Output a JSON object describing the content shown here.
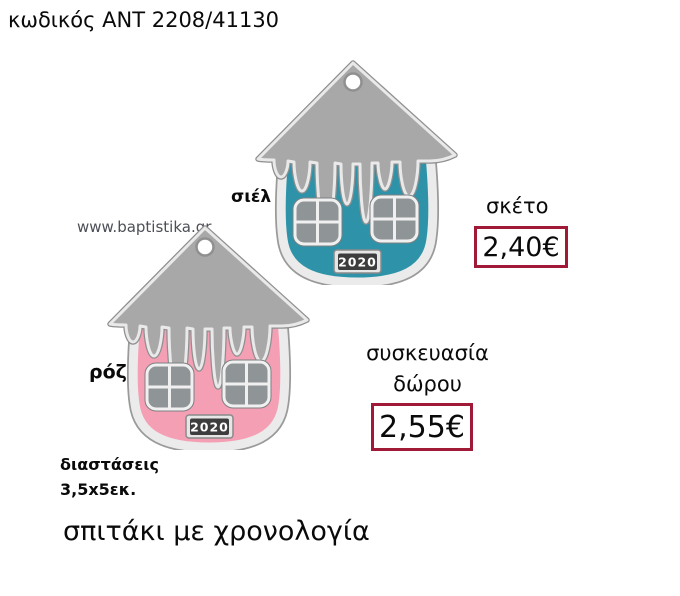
{
  "header": {
    "product_code": "κωδικός ΑΝΤ 2208/41130"
  },
  "watermark": {
    "text": "www.baptistika.gr",
    "color": "#4c4f56"
  },
  "product": {
    "year": "2020",
    "caption": "σπιτάκι με χρονολογία",
    "dimensions_label": "διαστάσεις",
    "dimensions_value": "3,5x5εκ."
  },
  "variants": [
    {
      "label": "σιέλ",
      "color": "#2e93a8"
    },
    {
      "label": "ρόζ",
      "color": "#f59fb5"
    }
  ],
  "pricing": {
    "plain": {
      "label": "σκέτο",
      "price": "2,40€"
    },
    "gift_wrap": {
      "label_line1": "συσκευασία",
      "label_line2": "δώρου",
      "price": "2,55€"
    }
  },
  "colors": {
    "price_box_border": "#A01937",
    "roof": "#a8a8a8",
    "silver_frame": "#ebebeb",
    "window": "#8f9496",
    "plaque_bg": "#3d3d3d"
  }
}
